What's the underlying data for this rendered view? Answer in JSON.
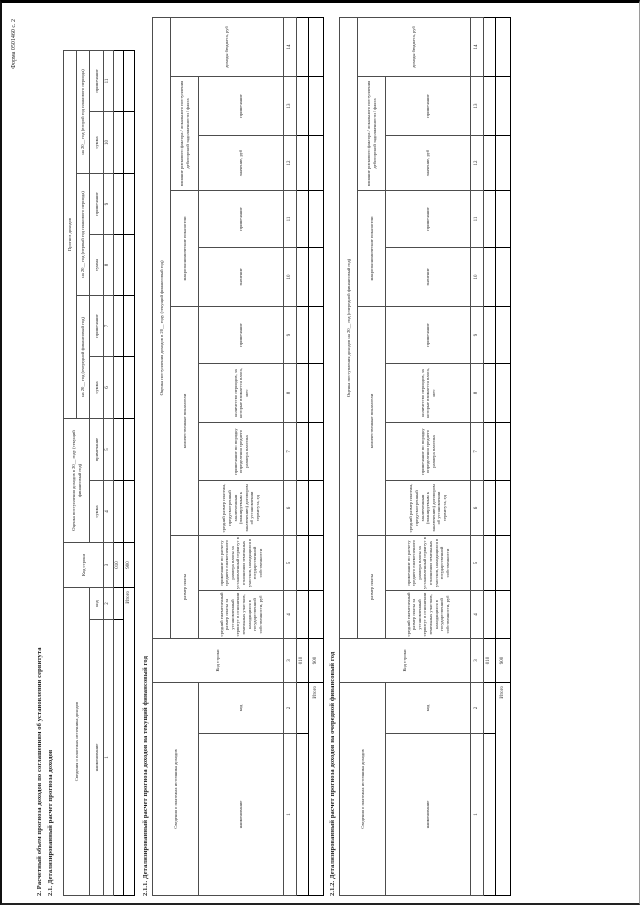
{
  "page": {
    "form_label": "Форма 0501460 с. 2"
  },
  "headings": {
    "s2": "2. Расчетный объем прогноза доходов по соглашениям об установлении сервитута",
    "s21": "2.1. Детализированный расчет прогноза доходов",
    "s211": "2.1.1. Детализированный расчет прогноза доходов на текущий финансовый год",
    "s212": "2.1.2. Детализированный расчет прогноза доходов на очередной финансовый год"
  },
  "tables": {
    "t21": {
      "width": 845,
      "col_widths": [
        276,
        32,
        45,
        62,
        62,
        62,
        61,
        61,
        61,
        62,
        61
      ],
      "row_heights": [
        13,
        13,
        14,
        10,
        10,
        11
      ],
      "rows": [
        [
          {
            "t": "Сведения о платежах источника доходов",
            "cs": 2,
            "rs": 2
          },
          {
            "t": "Код строки",
            "rs": 3
          },
          {
            "t": "Оценка поступления доходов в 20__ году (текущий финансовый год)",
            "cs": 2,
            "rs": 2
          },
          {
            "t": "Прогноз доходов",
            "cs": 6
          }
        ],
        [
          {
            "t": "на 20__ год (очередной финансовый год)",
            "cs": 2
          },
          {
            "t": "на 20__ год (первый год планового периода)",
            "cs": 2
          },
          {
            "t": "на 20__ год (второй год планового периода)",
            "cs": 2
          }
        ],
        [
          {
            "t": "наименование"
          },
          {
            "t": "код"
          },
          {
            "t": "сумма"
          },
          {
            "t": "примечание"
          },
          {
            "t": "сумма"
          },
          {
            "t": "примечание"
          },
          {
            "t": "сумма"
          },
          {
            "t": "примечание"
          },
          {
            "t": "сумма"
          },
          {
            "t": "примечание"
          }
        ],
        [
          {
            "t": "1"
          },
          {
            "t": "2"
          },
          {
            "t": "3"
          },
          {
            "t": "4"
          },
          {
            "t": "5"
          },
          {
            "t": "6"
          },
          {
            "t": "7"
          },
          {
            "t": "8"
          },
          {
            "t": "9"
          },
          {
            "t": "10"
          },
          {
            "t": "11"
          }
        ]
      ],
      "data_rows": [
        [
          {
            "t": ""
          },
          {
            "t": ""
          },
          {
            "t": "010"
          },
          {
            "t": ""
          },
          {
            "t": ""
          },
          {
            "t": ""
          },
          {
            "t": ""
          },
          {
            "t": ""
          },
          {
            "t": ""
          },
          {
            "t": ""
          },
          {
            "t": ""
          }
        ],
        [
          {
            "t": "Итого",
            "cs": 2,
            "al": "r"
          },
          {
            "t": "900"
          },
          {
            "t": ""
          },
          {
            "t": ""
          },
          {
            "t": ""
          },
          {
            "t": ""
          },
          {
            "t": ""
          },
          {
            "t": ""
          },
          {
            "t": ""
          },
          {
            "t": ""
          }
        ]
      ]
    },
    "t211": {
      "width": 878,
      "col_widths": [
        162,
        51,
        44,
        48,
        55,
        55,
        58,
        59,
        57,
        59,
        57,
        55,
        59,
        59
      ],
      "row_heights": [
        18,
        28,
        85,
        13,
        12,
        15
      ],
      "rows": [
        [
          {
            "t": "Сведения о платежах источника доходов",
            "cs": 2,
            "rs": 2
          },
          {
            "t": "Код строки",
            "rs": 3
          },
          {
            "t": "Оценка поступления доходов в 20__ году (текущий финансовый год)",
            "cs": 11
          }
        ],
        [
          {
            "t": "размер платы",
            "cs": 2
          },
          {
            "t": "количественные показатели",
            "cs": 4
          },
          {
            "t": "макроэкономические показатели",
            "cs": 2
          },
          {
            "t": "влияние рискового фактора / локального поступления дебиторской задолженности / факта",
            "cs": 2
          },
          {
            "t": "доходы бюджета, руб",
            "rs": 2
          }
        ],
        [
          {
            "t": "наименование"
          },
          {
            "t": "код"
          },
          {
            "t": "средний ежемесячный размер платы за установленный сервитут в отношении земельных участков, находящихся в государственной собственности, руб"
          },
          {
            "t": "примечание по расчету среднего ежемесячного размера платы за установленный сервитут в отношении земельных участков, находящихся в государственной собственности"
          },
          {
            "t": "средний размер платежа, предусмотренный заключенным (планируемым к заключению) договором об установлении сервитута, ед"
          },
          {
            "t": "примечание по порядку определения среднего размера платежа"
          },
          {
            "t": "количество периодов, за которые взимается плата, мес"
          },
          {
            "t": "примечание"
          },
          {
            "t": "значение"
          },
          {
            "t": "примечание"
          },
          {
            "t": "значение, руб"
          },
          {
            "t": "примечание"
          }
        ],
        [
          {
            "t": "1"
          },
          {
            "t": "2"
          },
          {
            "t": "3"
          },
          {
            "t": "4"
          },
          {
            "t": "5"
          },
          {
            "t": "6"
          },
          {
            "t": "7"
          },
          {
            "t": "8"
          },
          {
            "t": "9"
          },
          {
            "t": "10"
          },
          {
            "t": "11"
          },
          {
            "t": "12"
          },
          {
            "t": "13"
          },
          {
            "t": "14"
          }
        ]
      ],
      "data_rows": [
        [
          {
            "t": ""
          },
          {
            "t": ""
          },
          {
            "t": "010"
          },
          {
            "t": ""
          },
          {
            "t": ""
          },
          {
            "t": ""
          },
          {
            "t": ""
          },
          {
            "t": ""
          },
          {
            "t": ""
          },
          {
            "t": ""
          },
          {
            "t": ""
          },
          {
            "t": ""
          },
          {
            "t": ""
          },
          {
            "t": ""
          }
        ],
        [
          {
            "t": "Итого",
            "cs": 2,
            "al": "r"
          },
          {
            "t": "900"
          },
          {
            "t": ""
          },
          {
            "t": ""
          },
          {
            "t": ""
          },
          {
            "t": ""
          },
          {
            "t": ""
          },
          {
            "t": ""
          },
          {
            "t": ""
          },
          {
            "t": ""
          },
          {
            "t": ""
          },
          {
            "t": ""
          },
          {
            "t": ""
          }
        ]
      ]
    },
    "t212": {
      "width": 878,
      "col_widths": [
        162,
        51,
        44,
        48,
        55,
        55,
        58,
        59,
        57,
        59,
        57,
        55,
        59,
        59
      ],
      "row_heights": [
        18,
        28,
        85,
        13,
        12,
        15
      ],
      "rows": [
        [
          {
            "t": "Сведения о платежах источника доходов",
            "cs": 2,
            "rs": 2
          },
          {
            "t": "Код строки",
            "rs": 3
          },
          {
            "t": "Оценка поступления доходов на 20__ год (очередной финансовый год)",
            "cs": 11
          }
        ],
        [
          {
            "t": "размер платы",
            "cs": 2
          },
          {
            "t": "количественные показатели",
            "cs": 4
          },
          {
            "t": "макроэкономические показатели",
            "cs": 2
          },
          {
            "t": "влияние рискового фактора / локального поступления дебиторской задолженности / факта",
            "cs": 2
          },
          {
            "t": "доходы бюджета, руб",
            "rs": 2
          }
        ],
        [
          {
            "t": "наименование"
          },
          {
            "t": "код"
          },
          {
            "t": "средний ежемесячный размер платы за установленный сервитут в отношении земельных участков, находящихся в государственной собственности, руб"
          },
          {
            "t": "примечание по расчету среднего ежемесячного размера платы за установленный сервитут в отношении земельных участков, находящихся в государственной собственности"
          },
          {
            "t": "средний размер платежа, предусмотренный заключенным (планируемым к заключению) договором об установлении сервитута, ед"
          },
          {
            "t": "примечание по порядку определения среднего размера платежа"
          },
          {
            "t": "количество периодов, за которые взимается плата, мес"
          },
          {
            "t": "примечание"
          },
          {
            "t": "значение"
          },
          {
            "t": "примечание"
          },
          {
            "t": "значение, руб"
          },
          {
            "t": "примечание"
          }
        ],
        [
          {
            "t": "1"
          },
          {
            "t": "2"
          },
          {
            "t": "3"
          },
          {
            "t": "4"
          },
          {
            "t": "5"
          },
          {
            "t": "6"
          },
          {
            "t": "7"
          },
          {
            "t": "8"
          },
          {
            "t": "9"
          },
          {
            "t": "10"
          },
          {
            "t": "11"
          },
          {
            "t": "12"
          },
          {
            "t": "13"
          },
          {
            "t": "14"
          }
        ]
      ],
      "data_rows": [
        [
          {
            "t": ""
          },
          {
            "t": ""
          },
          {
            "t": "010"
          },
          {
            "t": ""
          },
          {
            "t": ""
          },
          {
            "t": ""
          },
          {
            "t": ""
          },
          {
            "t": ""
          },
          {
            "t": ""
          },
          {
            "t": ""
          },
          {
            "t": ""
          },
          {
            "t": ""
          },
          {
            "t": ""
          },
          {
            "t": ""
          }
        ],
        [
          {
            "t": "Итого",
            "cs": 2,
            "al": "r"
          },
          {
            "t": "900"
          },
          {
            "t": ""
          },
          {
            "t": ""
          },
          {
            "t": ""
          },
          {
            "t": ""
          },
          {
            "t": ""
          },
          {
            "t": ""
          },
          {
            "t": ""
          },
          {
            "t": ""
          },
          {
            "t": ""
          },
          {
            "t": ""
          },
          {
            "t": ""
          }
        ]
      ]
    }
  }
}
